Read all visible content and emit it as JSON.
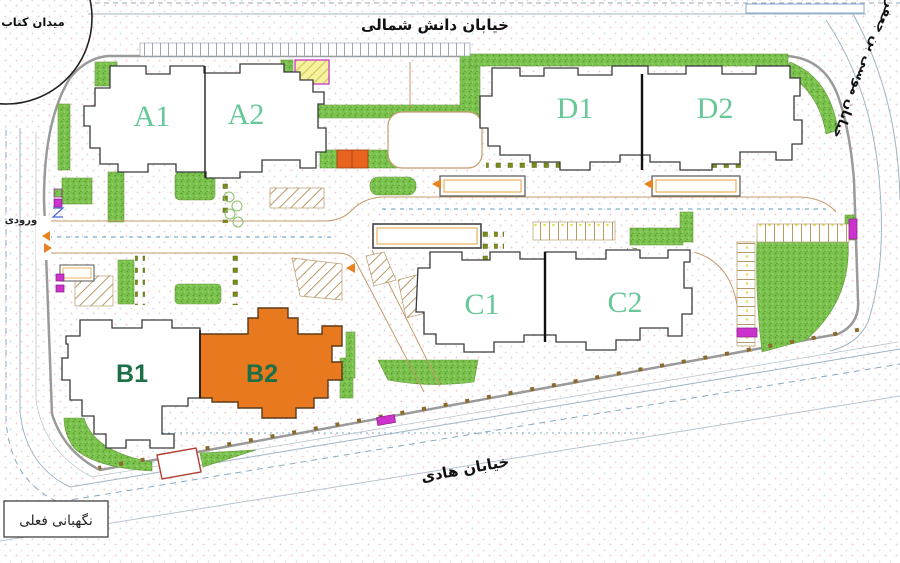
{
  "plan": {
    "streets": {
      "north": "خیابان دانش شمالی",
      "east": "خیابان موسی بن جعفر",
      "south": "خیابان هادی"
    },
    "landmarks": {
      "square": "میدان کتاب",
      "guard": "نگهبانی فعلی",
      "entrance": "ورودی"
    },
    "buildings": [
      {
        "id": "A1",
        "label": "A1",
        "highlighted": false
      },
      {
        "id": "A2",
        "label": "A2",
        "highlighted": false
      },
      {
        "id": "B1",
        "label": "B1",
        "highlighted": false
      },
      {
        "id": "B2",
        "label": "B2",
        "highlighted": true
      },
      {
        "id": "C1",
        "label": "C1",
        "highlighted": false
      },
      {
        "id": "C2",
        "label": "C2",
        "highlighted": false
      },
      {
        "id": "D1",
        "label": "D1",
        "highlighted": false
      },
      {
        "id": "D2",
        "label": "D2",
        "highlighted": false
      }
    ],
    "colors": {
      "highlight_building": "#e8791e",
      "grass": "#7cc24e",
      "label_light_green": "#66c897",
      "label_dark_green": "#1d6f47",
      "car_magenta": "#cc33cc",
      "utility_yellow": "#f7f2a0",
      "road_edge_tan": "#c49a6a",
      "centerline_blue": "#5b9bc0"
    }
  }
}
